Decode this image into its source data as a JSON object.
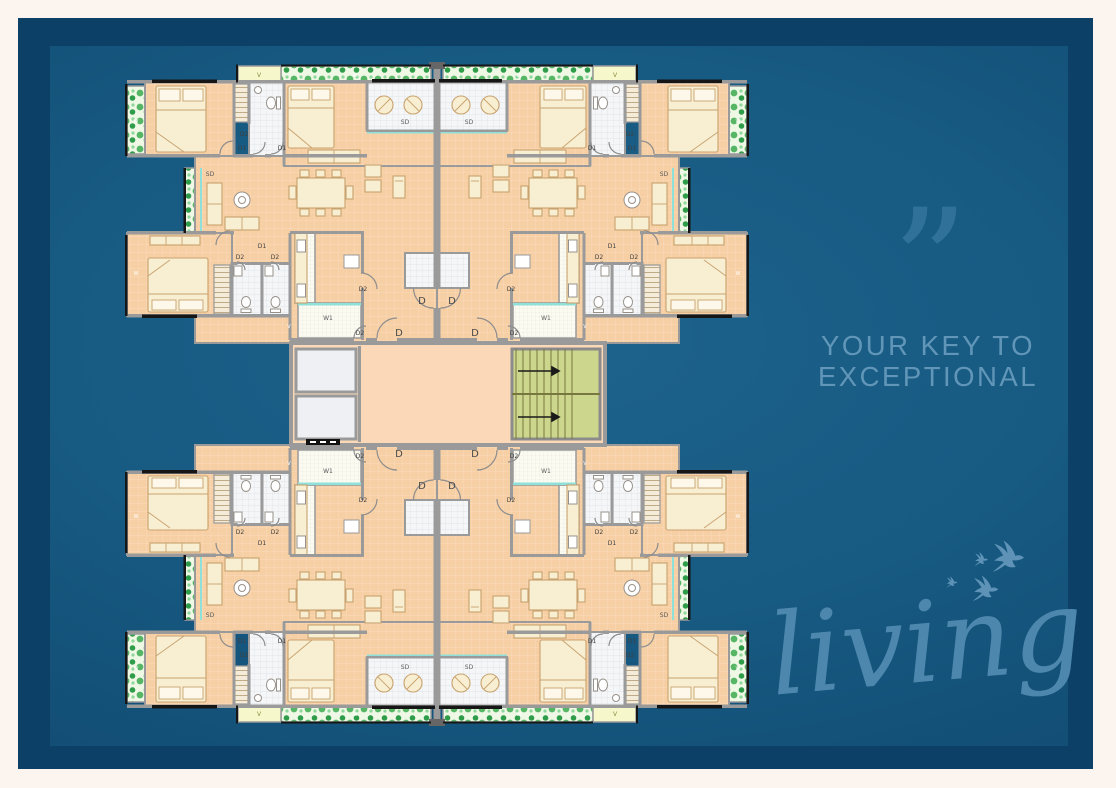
{
  "page": {
    "background_color": "#fbf4ef",
    "frame_color": "#0d4066",
    "panel_color": "#15577f"
  },
  "right_panel": {
    "quote_glyph": "”",
    "tagline_line1": "YOUR KEY TO",
    "tagline_line2": "EXCEPTIONAL",
    "script_word": "living",
    "tagline_color": "#6196b8",
    "quote_color": "#2f7199",
    "script_color": "#4d87ae",
    "birds_color": "#5e93b7"
  },
  "floor_plan": {
    "type": "residential-typical-floor-plan",
    "door_window_codes": [
      "D",
      "D1",
      "D2",
      "SD",
      "W",
      "W1",
      "V"
    ],
    "colors": {
      "floor": "#f7cfa4",
      "lobby": "#fbd9b8",
      "wall": "#9a9a9a",
      "bathroom_tile": "#f4f6f8",
      "planter": "#eef8e4",
      "stair": "#ccd78d",
      "elevator": "#eef0f3",
      "balcony_threshold": "#8fe0d8",
      "vent_box": "#f7f7cc"
    },
    "quadrant_labels": [
      {
        "t": "V",
        "x": 137,
        "y": 17,
        "s": 6,
        "c": "#8a8a3f"
      },
      {
        "t": "W",
        "x": 233,
        "y": 17,
        "s": 5,
        "c": "#ffffff"
      },
      {
        "t": "W",
        "x": 14,
        "y": 63,
        "s": 5,
        "c": "#ffffff"
      },
      {
        "t": "W",
        "x": 14,
        "y": 215,
        "s": 5,
        "c": "#ffffff"
      },
      {
        "t": "D2",
        "x": 122,
        "y": 76,
        "s": 6,
        "c": "#3f3f3f"
      },
      {
        "t": "D1",
        "x": 120,
        "y": 90,
        "s": 6,
        "c": "#3f3f3f"
      },
      {
        "t": "D1",
        "x": 160,
        "y": 90,
        "s": 6,
        "c": "#3f3f3f"
      },
      {
        "t": "SD",
        "x": 283,
        "y": 64,
        "s": 6,
        "c": "#5a5a5a"
      },
      {
        "t": "SD",
        "x": 88,
        "y": 116,
        "s": 6,
        "c": "#5a5a5a"
      },
      {
        "t": "D1",
        "x": 140,
        "y": 188,
        "s": 6,
        "c": "#3f3f3f"
      },
      {
        "t": "D2",
        "x": 118,
        "y": 199,
        "s": 6,
        "c": "#3f3f3f"
      },
      {
        "t": "D2",
        "x": 153,
        "y": 199,
        "s": 6,
        "c": "#3f3f3f"
      },
      {
        "t": "W1",
        "x": 206,
        "y": 260,
        "s": 6,
        "c": "#5a5a5a"
      },
      {
        "t": "V",
        "x": 167,
        "y": 268,
        "s": 5,
        "c": "#ffffff"
      },
      {
        "t": "D2",
        "x": 241,
        "y": 231,
        "s": 6,
        "c": "#3f3f3f"
      },
      {
        "t": "D2",
        "x": 238,
        "y": 275,
        "s": 6,
        "c": "#3f3f3f"
      },
      {
        "t": "D",
        "x": 300,
        "y": 244,
        "s": 10,
        "c": "#4a4a4a"
      },
      {
        "t": "D",
        "x": 277,
        "y": 276,
        "s": 10,
        "c": "#4a4a4a"
      }
    ]
  }
}
